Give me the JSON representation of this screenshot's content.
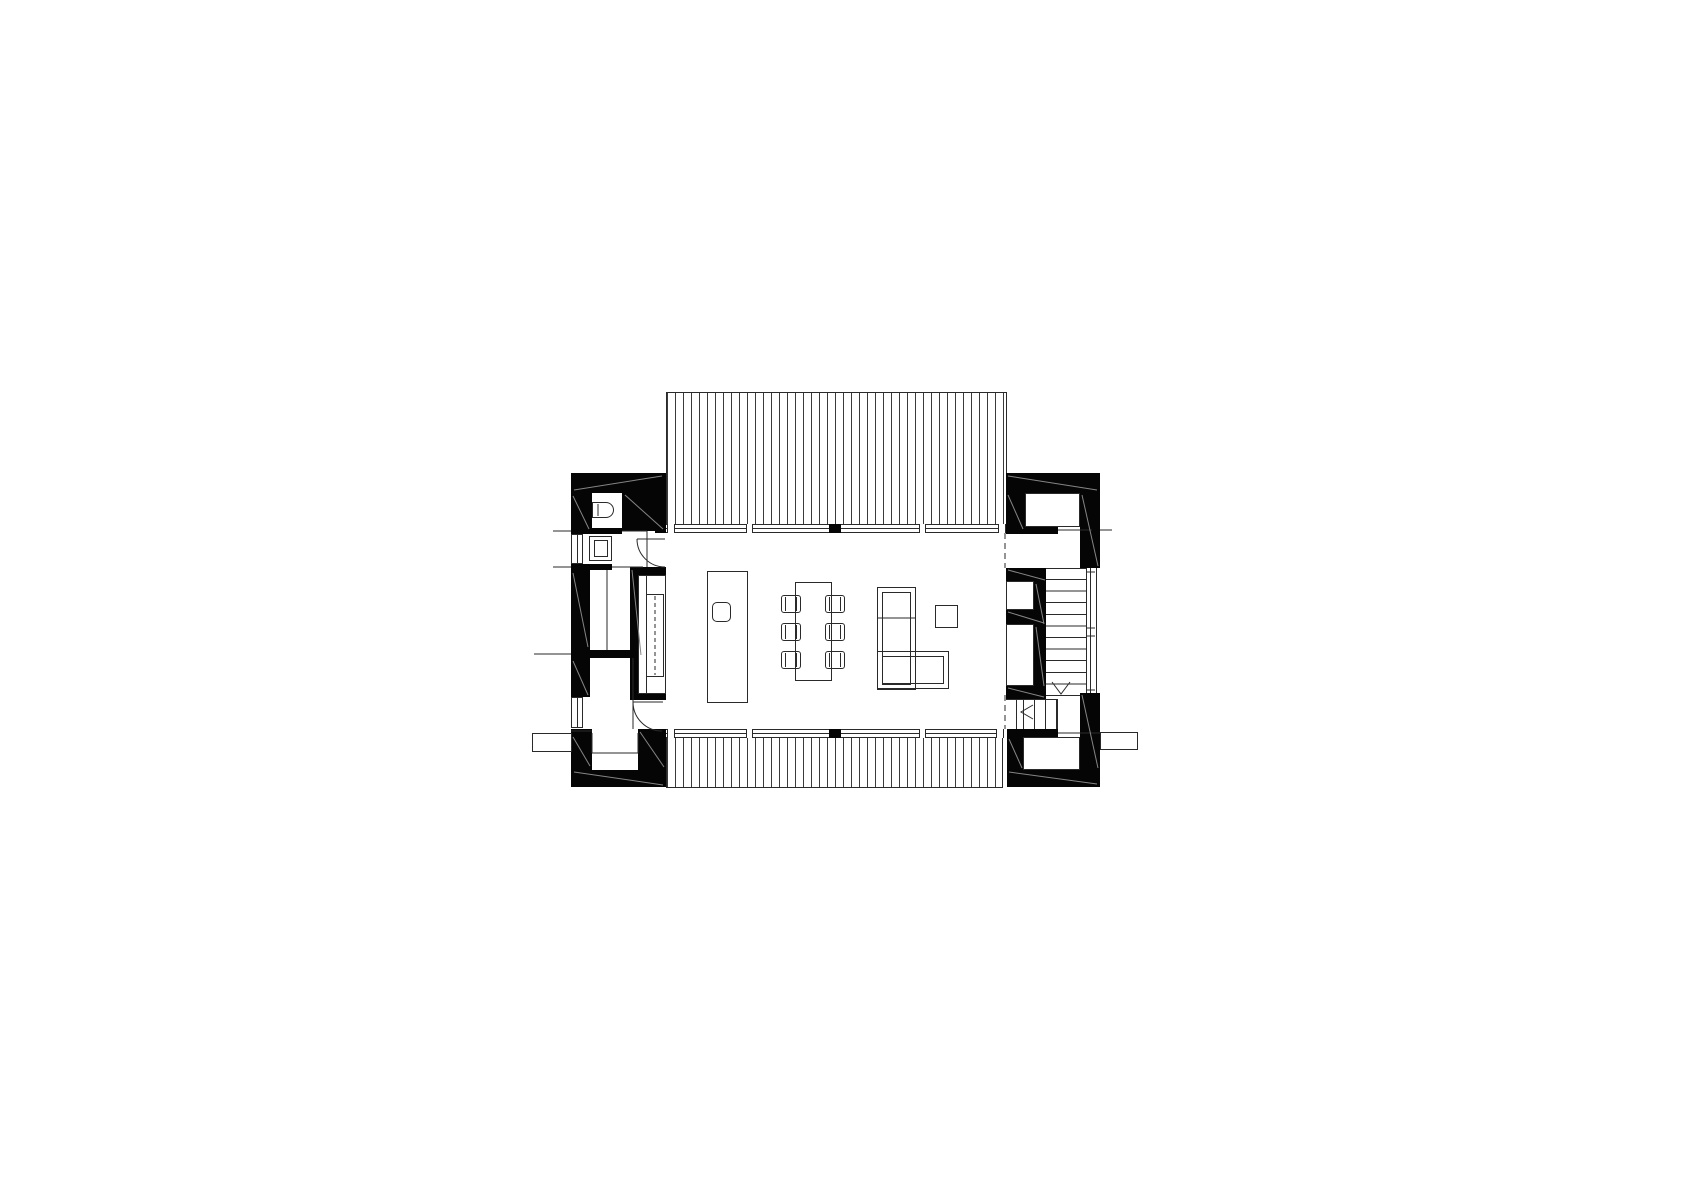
{
  "drawing": {
    "kind": "architectural floor plan, ground floor",
    "style": "black-and-white CAD linework, no text or dimensions visible",
    "colors": {
      "background": "#ffffff",
      "wall_poche": "#050505",
      "line": "#2a2a2a",
      "hairline_diagonal": "#808080"
    },
    "spaces": [
      "upper-deck-terrace",
      "wc",
      "washroom",
      "storage-room",
      "corridor",
      "entry-hall",
      "open-living-dining-kitchen",
      "stair-hall",
      "staircase",
      "lower-store-room",
      "lower-deck-terrace"
    ],
    "fixtures_and_furniture": [
      "toilet",
      "washbasin",
      "built-in-kitchen-counter",
      "kitchen-island-with-sink",
      "dining-table",
      "dining-chair",
      "l-shaped-sofa",
      "side-table"
    ],
    "counts": {
      "dining_chairs": 6,
      "upper_stair_treads": 11,
      "lower_stair_treads": 4,
      "door_swing_arcs": 2,
      "window_bands": 2
    },
    "decks": {
      "hatch_pattern": "dense vertical battens",
      "top_deck_present": true,
      "bottom_deck_present": true
    },
    "stair_annotations": [
      "down-arrow-v",
      "left-chevron-arrow"
    ],
    "window_band_features": [
      "end-posts",
      "third-point-mullions",
      "central-black-mullion-block"
    ]
  }
}
